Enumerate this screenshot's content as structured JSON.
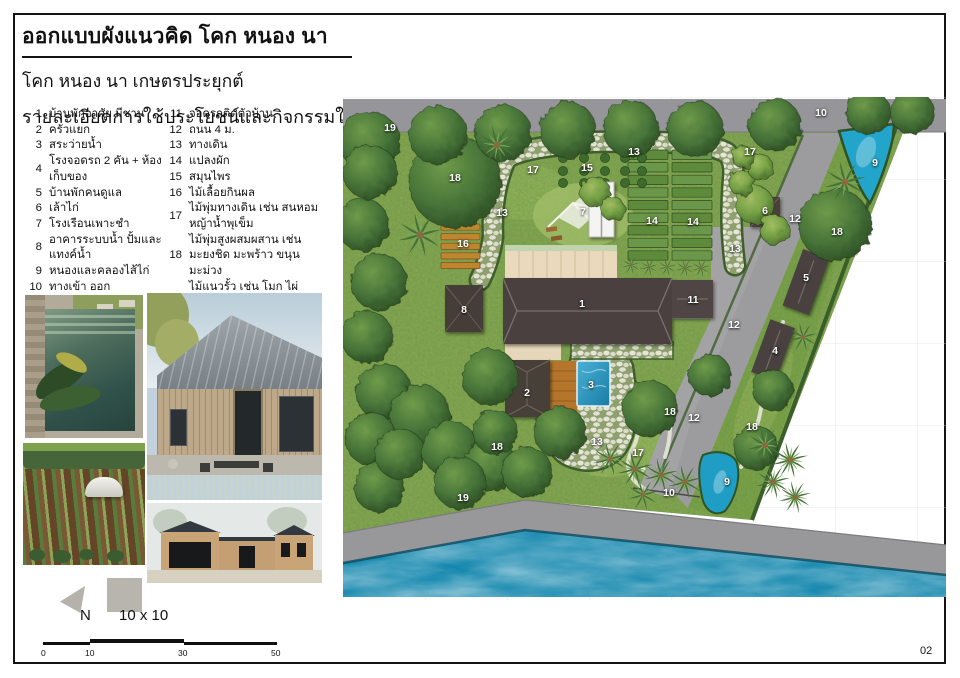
{
  "header": {
    "title": "ออกแบบผังแนวคิด โคก หนอง นา",
    "subtitle": "โคก หนอง นา เกษตรประยุกต์",
    "section_heading": "รายละเอียดการใช้ประโยชน์และกิจกรรมในพื้นที่"
  },
  "legend": {
    "column1": [
      {
        "num": "1",
        "text": "บ้านพักอาศัย มีชาน"
      },
      {
        "num": "2",
        "text": "ครัวแยก"
      },
      {
        "num": "3",
        "text": "สระว่ายน้ำ"
      },
      {
        "num": "4",
        "text": "โรงจอดรถ 2 คัน + ห้องเก็บของ"
      },
      {
        "num": "5",
        "text": "บ้านพักคนดูแล"
      },
      {
        "num": "6",
        "text": "เล้าไก่"
      },
      {
        "num": "7",
        "text": "โรงเรือนเพาะชำ"
      },
      {
        "num": "8",
        "text": "อาคารระบบน้ำ ปั้มและแทงค์น้ำ"
      },
      {
        "num": "9",
        "text": "หนองและคลองไส้ไก่"
      },
      {
        "num": "10",
        "text": "ทางเข้า ออก"
      }
    ],
    "column2": [
      {
        "num": "11",
        "text": "จอดรถติดตัวบ้าน"
      },
      {
        "num": "12",
        "text": "ถนน 4 ม."
      },
      {
        "num": "13",
        "text": "ทางเดิน"
      },
      {
        "num": "14",
        "text": "แปลงผัก"
      },
      {
        "num": "15",
        "text": "สมุนไพร"
      },
      {
        "num": "16",
        "text": "ไม้เลื้อยกินผล"
      },
      {
        "num": "17",
        "text": "ไม้พุ่มทางเดิน เช่น สนหอม\nหญ้าน้ำพุเข็ม"
      },
      {
        "num": "18",
        "text": "ไม้พุ่มสูงผสมผสาน เช่น\nมะยงชิด มะพร้าว ขนุน มะม่วง"
      },
      {
        "num": "19",
        "text": "ไม้แนวรั้ว เช่น โมก ไผ่ มะม่วง\nสะเดา"
      }
    ]
  },
  "plan": {
    "labels": [
      {
        "n": "19",
        "x": 47,
        "y": 31
      },
      {
        "n": "18",
        "x": 112,
        "y": 81
      },
      {
        "n": "17",
        "x": 190,
        "y": 73
      },
      {
        "n": "13",
        "x": 159,
        "y": 116
      },
      {
        "n": "15",
        "x": 244,
        "y": 71
      },
      {
        "n": "7",
        "x": 240,
        "y": 115
      },
      {
        "n": "13",
        "x": 291,
        "y": 55
      },
      {
        "n": "17",
        "x": 407,
        "y": 55
      },
      {
        "n": "10",
        "x": 478,
        "y": 16
      },
      {
        "n": "9",
        "x": 532,
        "y": 66
      },
      {
        "n": "14",
        "x": 309,
        "y": 124
      },
      {
        "n": "14",
        "x": 350,
        "y": 125
      },
      {
        "n": "6",
        "x": 422,
        "y": 114
      },
      {
        "n": "12",
        "x": 452,
        "y": 122
      },
      {
        "n": "13",
        "x": 392,
        "y": 152
      },
      {
        "n": "18",
        "x": 494,
        "y": 135
      },
      {
        "n": "16",
        "x": 120,
        "y": 147
      },
      {
        "n": "8",
        "x": 121,
        "y": 213
      },
      {
        "n": "1",
        "x": 239,
        "y": 207
      },
      {
        "n": "11",
        "x": 350,
        "y": 203
      },
      {
        "n": "5",
        "x": 463,
        "y": 181
      },
      {
        "n": "12",
        "x": 391,
        "y": 228
      },
      {
        "n": "4",
        "x": 432,
        "y": 254
      },
      {
        "n": "2",
        "x": 184,
        "y": 296
      },
      {
        "n": "3",
        "x": 248,
        "y": 288
      },
      {
        "n": "18",
        "x": 154,
        "y": 350
      },
      {
        "n": "13",
        "x": 254,
        "y": 345
      },
      {
        "n": "18",
        "x": 327,
        "y": 315
      },
      {
        "n": "12",
        "x": 351,
        "y": 321
      },
      {
        "n": "17",
        "x": 295,
        "y": 356
      },
      {
        "n": "18",
        "x": 409,
        "y": 330
      },
      {
        "n": "10",
        "x": 326,
        "y": 396
      },
      {
        "n": "9",
        "x": 384,
        "y": 385
      },
      {
        "n": "19",
        "x": 120,
        "y": 401
      }
    ]
  },
  "compass": {
    "north_label": "N",
    "grid_label": "10 x 10"
  },
  "scalebar": {
    "ticks": [
      "0",
      "10",
      "30",
      "50"
    ]
  },
  "page_number": "02",
  "colors": {
    "roof": "#4a403c",
    "water": "#1186ad",
    "pond": "#23a5cb",
    "grass": "#85a851",
    "road": "#98989b",
    "stone_path": "#e0dfd2",
    "wood": "#c0852f",
    "pool": "#2e9bc2"
  }
}
